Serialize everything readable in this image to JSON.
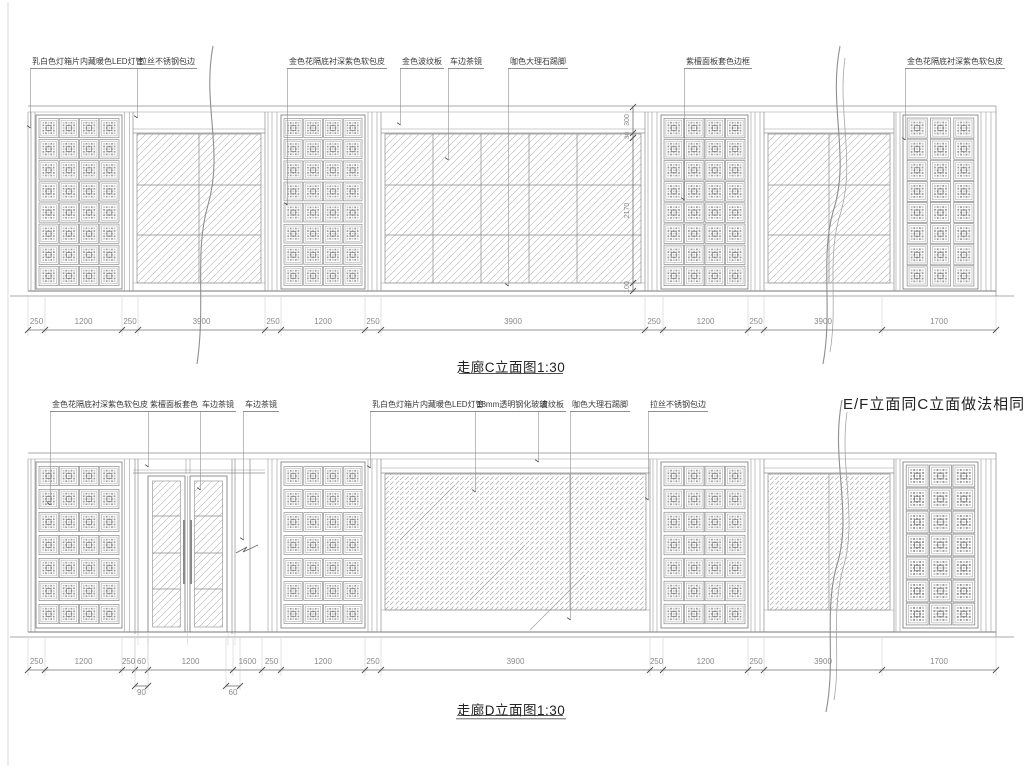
{
  "sheet": {
    "background": "#ffffff",
    "line_color": "#8d8d8d",
    "tick_color": "#4f4f4f"
  },
  "note_ef": "E/F立面同C立面做法相同",
  "elevation_c": {
    "title": "走廊C立面图1:30",
    "material_labels": [
      "乳白色灯箱片内藏暖色LED灯管",
      "拉丝不锈钢包边",
      "金色花隔底衬深紫色软包皮",
      "金色波纹板",
      "车边茶镜",
      "咖色大理石踢脚",
      "紫檀面板套色边框",
      "金色花隔底衬深紫色软包皮"
    ],
    "dims": [
      "250",
      "1200",
      "250",
      "3900",
      "250",
      "1200",
      "250",
      "3900",
      "250",
      "1200",
      "250",
      "3900",
      "1700"
    ],
    "vertical_dims": [
      "300",
      "30",
      "2170",
      "100"
    ]
  },
  "elevation_d": {
    "title": "走廊D立面图1:30",
    "material_labels": [
      "金色花隔底衬深紫色软包皮",
      "紫檀面板套色",
      "车边茶镜",
      "车边茶镜",
      "乳白色灯箱片内藏暖色LED灯管",
      "18mm透明钢化玻璃",
      "波纹板",
      "咖色大理石踢脚",
      "拉丝不锈钢包边"
    ],
    "dims": [
      "250",
      "1200",
      "250",
      "60",
      "1200",
      "1600",
      "250",
      "1200",
      "250",
      "3900",
      "250",
      "1200",
      "250",
      "3900",
      "1700"
    ],
    "sub_dims": [
      "90",
      "60"
    ]
  }
}
